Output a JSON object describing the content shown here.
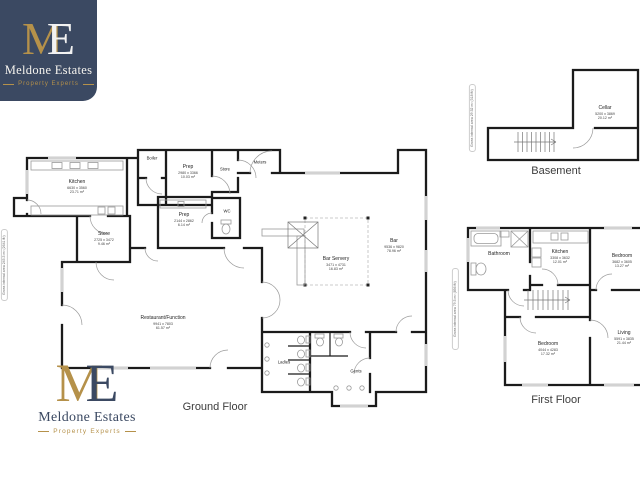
{
  "branding": {
    "monogram_m": "M",
    "monogram_e": "E",
    "company_name": "Meldone Estates",
    "tagline": "Property Experts",
    "navy": "#3b4962",
    "gold": "#b5914a"
  },
  "floors": {
    "ground": {
      "title": "Ground Floor",
      "gross_area_note": "Gross internal area 245.3 m² (2641 ft²)",
      "rooms": {
        "kitchen": {
          "name": "Kitchen",
          "dims": "6630 x 3560",
          "area": "23.71 m²"
        },
        "boiler": {
          "name": "Boiler"
        },
        "prep_top": {
          "name": "Prep",
          "dims": "2980 x 3366",
          "area": "10.03 m²"
        },
        "store_top": {
          "name": "Store"
        },
        "meters": {
          "name": "Meters"
        },
        "store_mid": {
          "name": "Store",
          "dims": "2725 x 3472",
          "area": "9.46 m²"
        },
        "prep_mid": {
          "name": "Prep",
          "dims": "2144 x 2862",
          "area": "6.14 m²"
        },
        "wc": {
          "name": "WC"
        },
        "bar_servery": {
          "name": "Bar Servery",
          "dims": "3471 x 4731",
          "area": "16.83 m²"
        },
        "bar": {
          "name": "Bar",
          "dims": "9536 x 9820",
          "area": "78.96 m²"
        },
        "restaurant": {
          "name": "Restaurant/Function",
          "dims": "9941 x 7803",
          "area": "61.57 m²"
        },
        "ladies": {
          "name": "Ladies"
        },
        "gents": {
          "name": "Gents"
        }
      }
    },
    "basement": {
      "title": "Basement",
      "gross_area_note": "Gross internal area 29.52 m² (318 ft²)",
      "rooms": {
        "cellar": {
          "name": "Cellar",
          "dims": "5200 x 3869",
          "area": "20.12 m²"
        }
      }
    },
    "first": {
      "title": "First Floor",
      "gross_area_note": "Gross internal area 79.5 m² (856 ft²)",
      "rooms": {
        "bathroom": {
          "name": "Bathroom"
        },
        "kitchen": {
          "name": "Kitchen",
          "dims": "3308 x 3632",
          "area": "12.01 m²"
        },
        "bedroom_1": {
          "name": "Bedroom",
          "dims": "3682 x 3605",
          "area": "13.27 m²"
        },
        "bedroom_2": {
          "name": "Bedroom",
          "dims": "4044 x 4283",
          "area": "17.32 m²"
        },
        "living": {
          "name": "Living",
          "dims": "5591 x 3835",
          "area": "21.44 m²"
        }
      }
    }
  }
}
